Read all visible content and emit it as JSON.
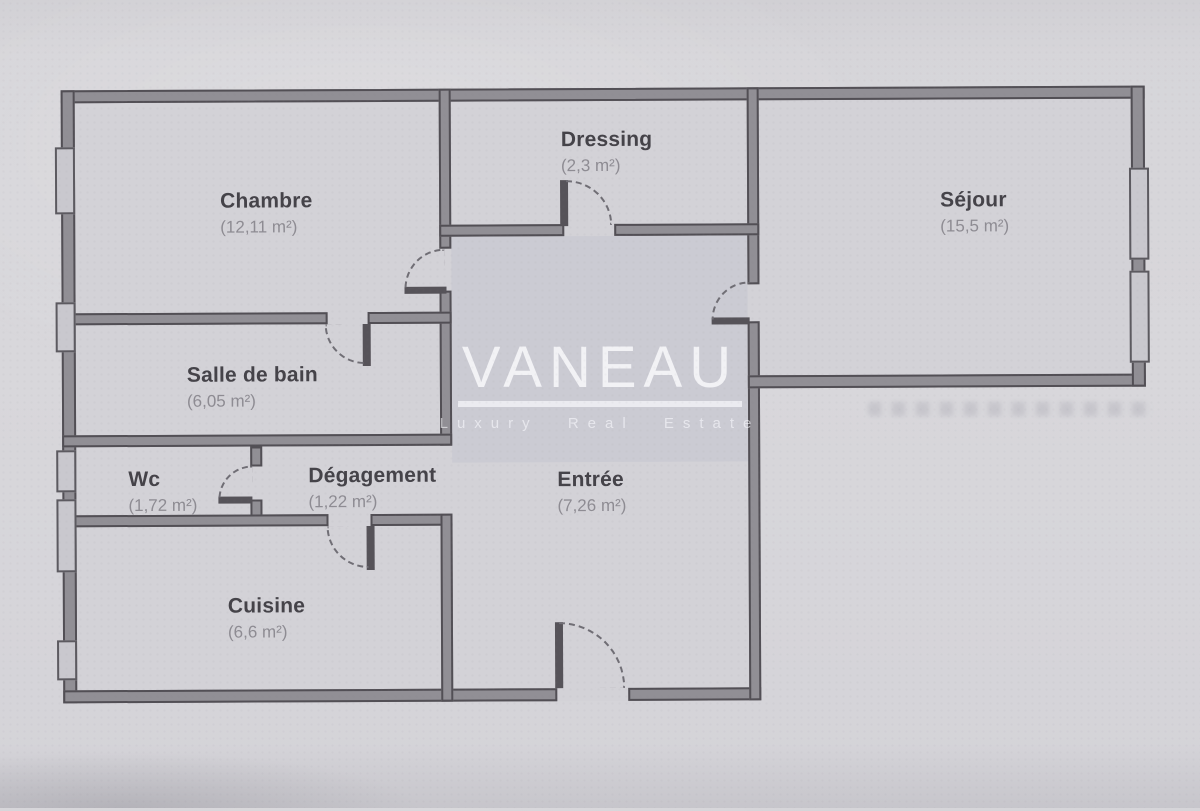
{
  "plan": {
    "type": "floor-plan",
    "rooms": [
      {
        "name": "Chambre",
        "area": "(12,11 m²)"
      },
      {
        "name": "Dressing",
        "area": "(2,3 m²)"
      },
      {
        "name": "Séjour",
        "area": "(15,5 m²)"
      },
      {
        "name": "Salle de bain",
        "area": "(6,05 m²)"
      },
      {
        "name": "Wc",
        "area": "(1,72 m²)"
      },
      {
        "name": "Dégagement",
        "area": "(1,22 m²)"
      },
      {
        "name": "Entrée",
        "area": "(7,26 m²)"
      },
      {
        "name": "Cuisine",
        "area": "(6,6 m²)"
      }
    ]
  },
  "watermark": {
    "brand": "VANEAU",
    "tagline": "Luxury Real Estate"
  },
  "colors": {
    "paper": "#d7d6da",
    "wall_fill": "#918f95",
    "wall_edge": "#524f55",
    "room_name": "#454349",
    "room_area": "#8e8c93",
    "watermark": "#ffffff"
  }
}
